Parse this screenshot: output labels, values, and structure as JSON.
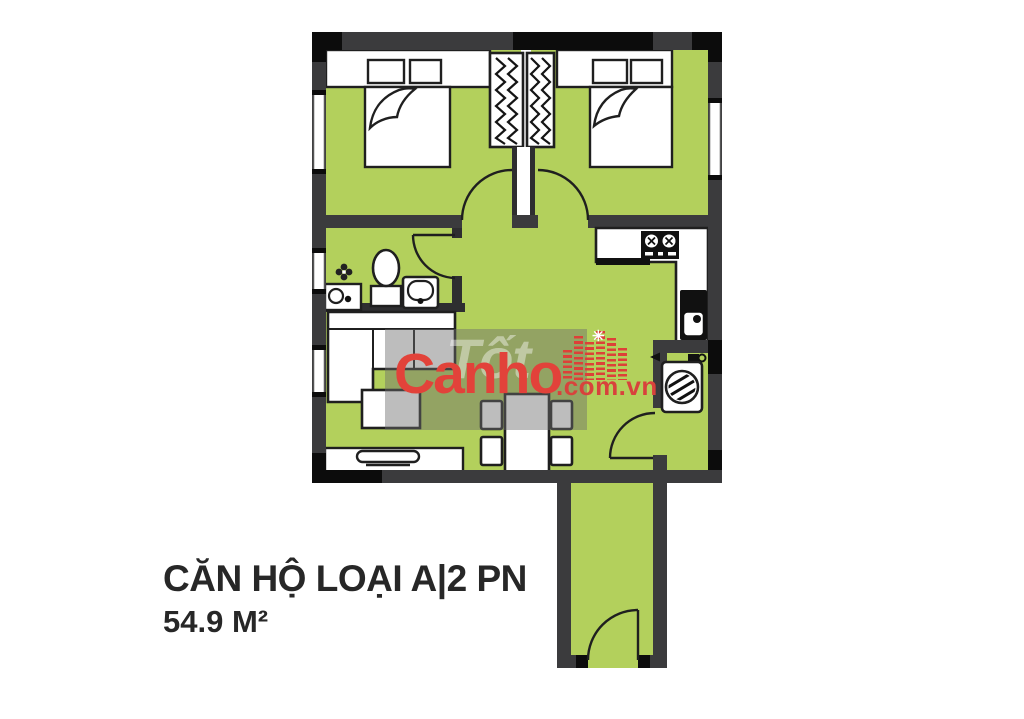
{
  "caption": {
    "title": "CĂN HỘ LOẠI A|2 PN",
    "area": "54.9 M²"
  },
  "watermark": {
    "brand": "Canho",
    "domain_suffix": ".com.vn",
    "ghost_text": "Tốt",
    "brand_color": "#e2423a"
  },
  "palette": {
    "floor_green": "#b3d05c",
    "wall_gray": "#3b3b3d",
    "wall_black": "#0c0c0c",
    "furniture_outline": "#1f1f1f",
    "furniture_fill": "#ffffff"
  },
  "floorplan": {
    "type": "apartment-2-bedroom",
    "rooms": [
      {
        "name": "bedroom-1",
        "furniture": [
          "double-bed",
          "two-pillows",
          "wardrobe"
        ]
      },
      {
        "name": "bedroom-2",
        "furniture": [
          "double-bed",
          "two-pillows",
          "wardrobe"
        ]
      },
      {
        "name": "bathroom",
        "furniture": [
          "toilet",
          "washbasin",
          "vanity-sink"
        ]
      },
      {
        "name": "kitchen",
        "furniture": [
          "l-shaped-counter",
          "stove-2-burner",
          "kitchen-sink"
        ]
      },
      {
        "name": "living-dining",
        "furniture": [
          "sofa",
          "coffee-table",
          "tv-cabinet",
          "dining-table",
          "four-chairs"
        ]
      },
      {
        "name": "laundry",
        "furniture": [
          "washing-machine",
          "faucet"
        ]
      },
      {
        "name": "entry-corridor",
        "furniture": [
          "entrance-door"
        ]
      }
    ],
    "doors": [
      "bedroom-1-door",
      "bedroom-2-door",
      "bathroom-door",
      "laundry-door",
      "entrance-door"
    ],
    "windows": [
      "left-wall-x3",
      "right-wall-x1"
    ]
  }
}
